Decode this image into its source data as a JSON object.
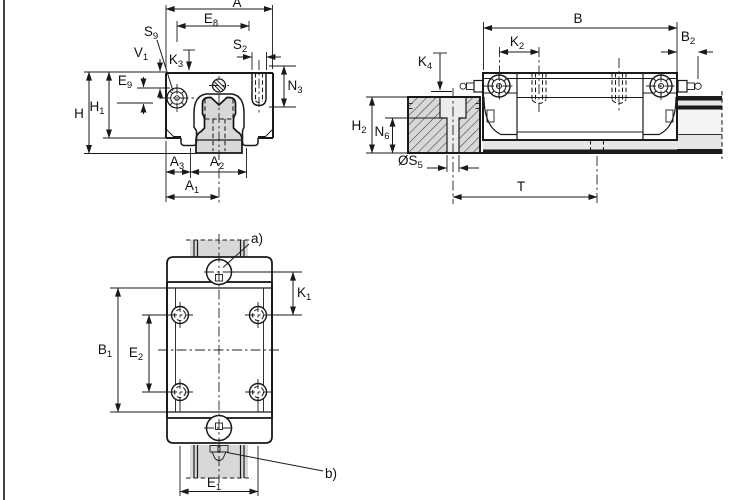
{
  "title": "Linear guideway carriage dimension drawing",
  "colors": {
    "line": "#1a1a1a",
    "rail_fill": "#d8d8d8",
    "section_fill": "#d8d8d8",
    "hole_fill": "#ececec",
    "band_light": "#f4f4f4",
    "band_gray": "#e6e6e6",
    "background": "#ffffff"
  },
  "views": {
    "front": {
      "name": "Front cross-section view",
      "labels": {
        "A": {
          "m": "A",
          "s": ""
        },
        "E8": {
          "m": "E",
          "s": "8"
        },
        "S9": {
          "m": "S",
          "s": "9"
        },
        "V1": {
          "m": "V",
          "s": "1"
        },
        "K3": {
          "m": "K",
          "s": "3"
        },
        "S2": {
          "m": "S",
          "s": "2"
        },
        "E9": {
          "m": "E",
          "s": "9"
        },
        "N3": {
          "m": "N",
          "s": "3"
        },
        "H": {
          "m": "H",
          "s": ""
        },
        "H1": {
          "m": "H",
          "s": "1"
        },
        "A3": {
          "m": "A",
          "s": "3"
        },
        "A2": {
          "m": "A",
          "s": "2"
        },
        "A1": {
          "m": "A",
          "s": "1"
        }
      }
    },
    "side": {
      "name": "Side elevation view",
      "labels": {
        "B": {
          "m": "B",
          "s": ""
        },
        "K2": {
          "m": "K",
          "s": "2"
        },
        "B2": {
          "m": "B",
          "s": "2"
        },
        "K4": {
          "m": "K",
          "s": "4"
        },
        "H2": {
          "m": "H",
          "s": "2"
        },
        "N6": {
          "m": "N",
          "s": "6"
        },
        "S5": {
          "m": "ØS",
          "s": "5"
        },
        "T": {
          "m": "T",
          "s": ""
        }
      }
    },
    "plan": {
      "name": "Top plan view",
      "labels": {
        "K1": {
          "m": "K",
          "s": "1"
        },
        "B1": {
          "m": "B",
          "s": "1"
        },
        "E2": {
          "m": "E",
          "s": "2"
        },
        "E1": {
          "m": "E",
          "s": "1"
        }
      },
      "notes": {
        "a": "a)",
        "b": "b)"
      }
    }
  }
}
